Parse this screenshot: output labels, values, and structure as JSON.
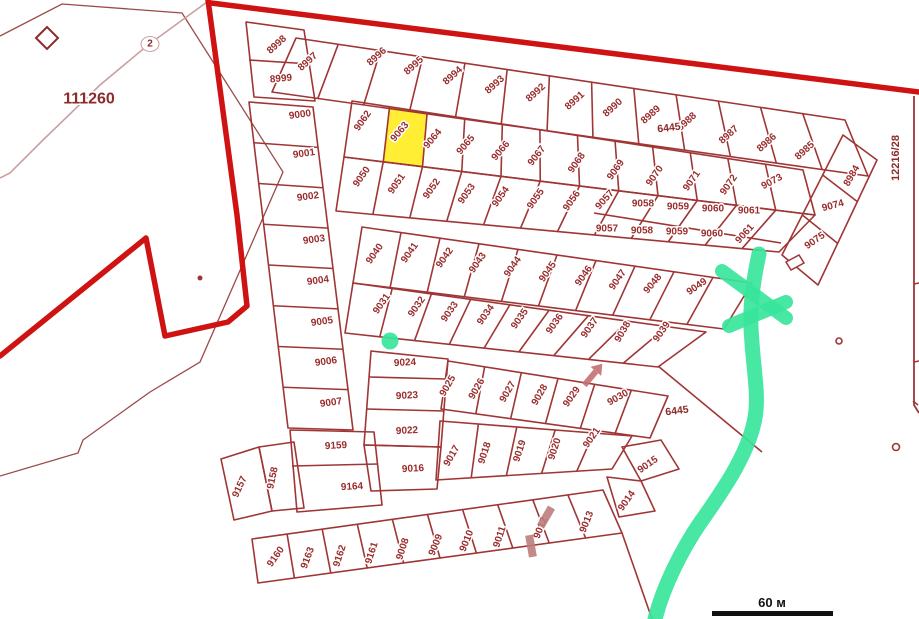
{
  "map": {
    "colors": {
      "parcel_line": "#a03535",
      "boundary_thick": "#cf1212",
      "road_thin": "#9b4a4a",
      "road_light": "#cb9fa0",
      "label": "#9a2c2c",
      "area_label": "#8b2b2b",
      "highlight_fill": "#ffee33",
      "marker_green": "#38e59c",
      "marker_pink": "#c4706f",
      "building_pink": "#bd7d7d",
      "scalebar": "#111111"
    },
    "highlight": {
      "parcel": "9063"
    },
    "scalebar": {
      "label": "60 м"
    },
    "area_labels": [
      {
        "text": "111260",
        "x": 89,
        "y": 99,
        "size": 16,
        "rot": 0,
        "big": true
      },
      {
        "text": "2",
        "x": 150,
        "y": 44,
        "size": 10,
        "rot": 0,
        "oval": true
      },
      {
        "text": "6445",
        "x": 669,
        "y": 128,
        "size": 10.5,
        "rot": -7
      },
      {
        "text": "6445",
        "x": 677,
        "y": 411,
        "size": 10.5,
        "rot": -7
      },
      {
        "text": "12216/28",
        "x": 896,
        "y": 158,
        "size": 11,
        "rot": -90
      }
    ],
    "parcels": [
      {
        "n": "8998",
        "x": 277,
        "y": 45,
        "r": -42
      },
      {
        "n": "8999",
        "x": 281,
        "y": 79,
        "r": -5
      },
      {
        "n": "8997",
        "x": 308,
        "y": 62,
        "r": -42
      },
      {
        "n": "8996",
        "x": 377,
        "y": 57,
        "r": -42
      },
      {
        "n": "8995",
        "x": 414,
        "y": 66,
        "r": -42
      },
      {
        "n": "8994",
        "x": 453,
        "y": 76,
        "r": -42
      },
      {
        "n": "8993",
        "x": 495,
        "y": 85,
        "r": -42
      },
      {
        "n": "8992",
        "x": 536,
        "y": 93,
        "r": -42
      },
      {
        "n": "8991",
        "x": 575,
        "y": 101,
        "r": -42
      },
      {
        "n": "8990",
        "x": 613,
        "y": 108,
        "r": -42
      },
      {
        "n": "8989",
        "x": 651,
        "y": 115,
        "r": -42
      },
      {
        "n": "8988",
        "x": 687,
        "y": 122,
        "r": -42
      },
      {
        "n": "8987",
        "x": 729,
        "y": 135,
        "r": -42
      },
      {
        "n": "8986",
        "x": 767,
        "y": 143,
        "r": -42
      },
      {
        "n": "8985",
        "x": 805,
        "y": 151,
        "r": -42
      },
      {
        "n": "9000",
        "x": 300,
        "y": 115,
        "r": -8
      },
      {
        "n": "9001",
        "x": 304,
        "y": 154,
        "r": -8
      },
      {
        "n": "9002",
        "x": 308,
        "y": 197,
        "r": -8
      },
      {
        "n": "9003",
        "x": 314,
        "y": 240,
        "r": -8
      },
      {
        "n": "9004",
        "x": 318,
        "y": 281,
        "r": -8
      },
      {
        "n": "9005",
        "x": 322,
        "y": 322,
        "r": -8
      },
      {
        "n": "9006",
        "x": 326,
        "y": 362,
        "r": -8
      },
      {
        "n": "9007",
        "x": 331,
        "y": 403,
        "r": -8
      },
      {
        "n": "9159",
        "x": 336,
        "y": 446,
        "r": -3
      },
      {
        "n": "9164",
        "x": 352,
        "y": 487,
        "r": -3
      },
      {
        "n": "9157",
        "x": 240,
        "y": 487,
        "r": -65
      },
      {
        "n": "9158",
        "x": 273,
        "y": 478,
        "r": -78
      },
      {
        "n": "9062",
        "x": 363,
        "y": 121,
        "r": -55
      },
      {
        "n": "9063",
        "x": 400,
        "y": 132,
        "r": -50
      },
      {
        "n": "9064",
        "x": 433,
        "y": 139,
        "r": -50
      },
      {
        "n": "9065",
        "x": 466,
        "y": 145,
        "r": -50
      },
      {
        "n": "9066",
        "x": 501,
        "y": 151,
        "r": -50
      },
      {
        "n": "9067",
        "x": 537,
        "y": 156,
        "r": -52
      },
      {
        "n": "9068",
        "x": 577,
        "y": 163,
        "r": -55
      },
      {
        "n": "9069",
        "x": 616,
        "y": 170,
        "r": -55
      },
      {
        "n": "9070",
        "x": 655,
        "y": 176,
        "r": -55
      },
      {
        "n": "9071",
        "x": 692,
        "y": 181,
        "r": -55
      },
      {
        "n": "9072",
        "x": 729,
        "y": 185,
        "r": -55
      },
      {
        "n": "9073",
        "x": 772,
        "y": 182,
        "r": -28
      },
      {
        "n": "9050",
        "x": 362,
        "y": 177,
        "r": -55
      },
      {
        "n": "9051",
        "x": 397,
        "y": 184,
        "r": -55
      },
      {
        "n": "9052",
        "x": 432,
        "y": 189,
        "r": -55
      },
      {
        "n": "9053",
        "x": 467,
        "y": 194,
        "r": -55
      },
      {
        "n": "9054",
        "x": 501,
        "y": 197,
        "r": -55
      },
      {
        "n": "9055",
        "x": 536,
        "y": 199,
        "r": -55
      },
      {
        "n": "9056",
        "x": 572,
        "y": 201,
        "r": -55
      },
      {
        "n": "9057",
        "x": 605,
        "y": 200,
        "r": -48
      },
      {
        "n": "9058",
        "x": 643,
        "y": 204,
        "r": 0
      },
      {
        "n": "9059",
        "x": 678,
        "y": 207,
        "r": 0
      },
      {
        "n": "9060",
        "x": 713,
        "y": 209,
        "r": 0
      },
      {
        "n": "9061",
        "x": 749,
        "y": 211,
        "r": 0
      },
      {
        "n": "9057",
        "x": 607,
        "y": 229,
        "r": 0
      },
      {
        "n": "9058",
        "x": 642,
        "y": 231,
        "r": 0
      },
      {
        "n": "9059",
        "x": 677,
        "y": 232,
        "r": 0
      },
      {
        "n": "9060",
        "x": 712,
        "y": 234,
        "r": 0
      },
      {
        "n": "9061",
        "x": 745,
        "y": 234,
        "r": -48
      },
      {
        "n": "9040",
        "x": 375,
        "y": 254,
        "r": -55
      },
      {
        "n": "9041",
        "x": 410,
        "y": 253,
        "r": -55
      },
      {
        "n": "9042",
        "x": 445,
        "y": 258,
        "r": -55
      },
      {
        "n": "9043",
        "x": 478,
        "y": 263,
        "r": -55
      },
      {
        "n": "9044",
        "x": 513,
        "y": 267,
        "r": -55
      },
      {
        "n": "9045",
        "x": 548,
        "y": 272,
        "r": -55
      },
      {
        "n": "9046",
        "x": 584,
        "y": 276,
        "r": -55
      },
      {
        "n": "9047",
        "x": 618,
        "y": 280,
        "r": -55
      },
      {
        "n": "9048",
        "x": 653,
        "y": 284,
        "r": -50
      },
      {
        "n": "9049",
        "x": 697,
        "y": 287,
        "r": -35
      },
      {
        "n": "9031",
        "x": 382,
        "y": 304,
        "r": -55
      },
      {
        "n": "9032",
        "x": 417,
        "y": 307,
        "r": -55
      },
      {
        "n": "9033",
        "x": 450,
        "y": 312,
        "r": -55
      },
      {
        "n": "9034",
        "x": 486,
        "y": 315,
        "r": -55
      },
      {
        "n": "9035",
        "x": 520,
        "y": 319,
        "r": -55
      },
      {
        "n": "9036",
        "x": 555,
        "y": 324,
        "r": -55
      },
      {
        "n": "9037",
        "x": 590,
        "y": 328,
        "r": -55
      },
      {
        "n": "9038",
        "x": 623,
        "y": 332,
        "r": -60
      },
      {
        "n": "9039",
        "x": 662,
        "y": 332,
        "r": -55
      },
      {
        "n": "9024",
        "x": 405,
        "y": 363,
        "r": -3
      },
      {
        "n": "9023",
        "x": 407,
        "y": 396,
        "r": -3
      },
      {
        "n": "9022",
        "x": 407,
        "y": 431,
        "r": -3
      },
      {
        "n": "9016",
        "x": 413,
        "y": 469,
        "r": -3
      },
      {
        "n": "9025",
        "x": 448,
        "y": 386,
        "r": -60
      },
      {
        "n": "9026",
        "x": 477,
        "y": 389,
        "r": -60
      },
      {
        "n": "9027",
        "x": 508,
        "y": 392,
        "r": -60
      },
      {
        "n": "9028",
        "x": 540,
        "y": 395,
        "r": -60
      },
      {
        "n": "9029",
        "x": 572,
        "y": 397,
        "r": -55
      },
      {
        "n": "9030",
        "x": 618,
        "y": 398,
        "r": -30
      },
      {
        "n": "9017",
        "x": 452,
        "y": 456,
        "r": -60
      },
      {
        "n": "9018",
        "x": 485,
        "y": 453,
        "r": -72
      },
      {
        "n": "9019",
        "x": 520,
        "y": 451,
        "r": -72
      },
      {
        "n": "9020",
        "x": 555,
        "y": 449,
        "r": -72
      },
      {
        "n": "9021",
        "x": 592,
        "y": 438,
        "r": -55
      },
      {
        "n": "9015",
        "x": 648,
        "y": 465,
        "r": -35
      },
      {
        "n": "9014",
        "x": 627,
        "y": 501,
        "r": -55
      },
      {
        "n": "9160",
        "x": 276,
        "y": 557,
        "r": -55
      },
      {
        "n": "9163",
        "x": 308,
        "y": 558,
        "r": -70
      },
      {
        "n": "9162",
        "x": 340,
        "y": 556,
        "r": -72
      },
      {
        "n": "9161",
        "x": 372,
        "y": 553,
        "r": -72
      },
      {
        "n": "9008",
        "x": 403,
        "y": 549,
        "r": -72
      },
      {
        "n": "9009",
        "x": 436,
        "y": 545,
        "r": -68
      },
      {
        "n": "9010",
        "x": 467,
        "y": 541,
        "r": -68
      },
      {
        "n": "9011",
        "x": 500,
        "y": 537,
        "r": -72
      },
      {
        "n": "9012",
        "x": 541,
        "y": 528,
        "r": -68
      },
      {
        "n": "9013",
        "x": 587,
        "y": 522,
        "r": -68
      },
      {
        "n": "8984",
        "x": 852,
        "y": 176,
        "r": -60
      },
      {
        "n": "9074",
        "x": 833,
        "y": 206,
        "r": -15
      },
      {
        "n": "9075",
        "x": 815,
        "y": 241,
        "r": -35
      }
    ]
  }
}
